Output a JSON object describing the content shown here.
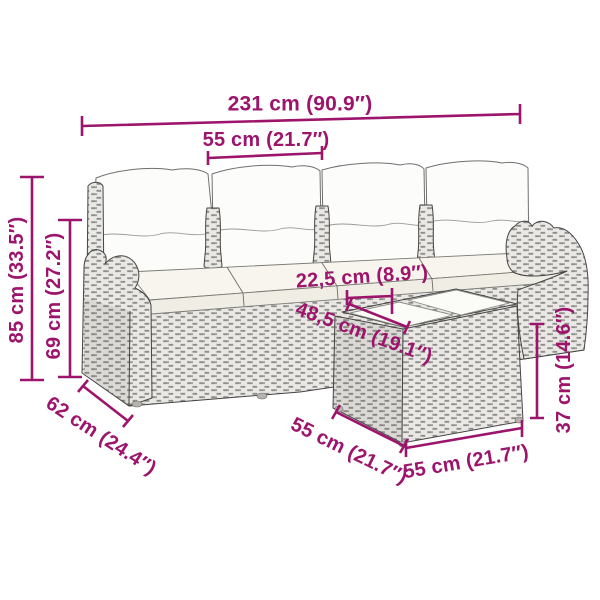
{
  "colors": {
    "dimension_accent": "#9C146B",
    "background": "#FFFFFF",
    "rattan_gray": "#E9E8E5",
    "cushion_white": "#F7F5ED"
  },
  "diagram": {
    "dim_total_width": "231 cm (90.9″)",
    "dim_seat_width": "55 cm (21.7″)",
    "dim_total_height": "85 cm (33.5″)",
    "dim_back_height": "69 cm (27.2″)",
    "dim_seat_depth": "62 cm (24.4″)",
    "dim_table_gap": "22,5 cm (8.9″)",
    "dim_table_diagonal": "48,5 cm (19.1″)",
    "dim_table_side": "55 cm (21.7″)",
    "dim_table_front": "55 cm (21.7″)",
    "dim_table_height": "37 cm (14.6″)"
  }
}
